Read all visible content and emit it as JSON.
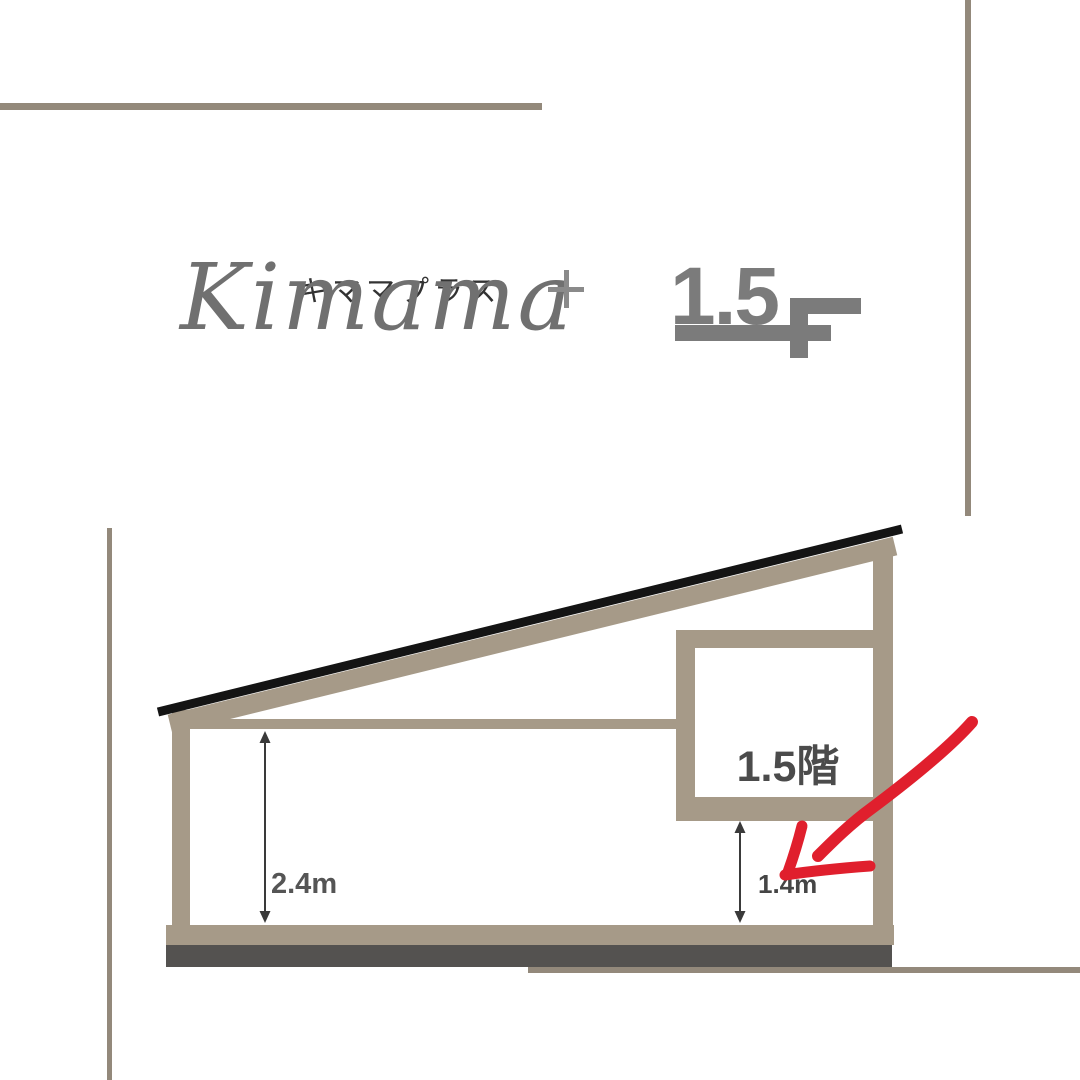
{
  "brand": {
    "katakana": "キママプラス",
    "script": "Kimama",
    "plus": "+"
  },
  "floor_mark": {
    "number": "1.5",
    "letter": "F"
  },
  "diagram": {
    "loft_label": "1.5階",
    "main_room_height": "2.4m",
    "loft_under_height": "1.4m"
  },
  "colors": {
    "taupe_structure": "#a69a88",
    "decor_rule": "#93897b",
    "roof_black": "#141414",
    "foundation_gray": "#545250",
    "marker_red": "#e01f2d",
    "logo_gray": "#7b7b7b",
    "script_gray": "#707070",
    "label_gray": "#4b4b4b"
  }
}
